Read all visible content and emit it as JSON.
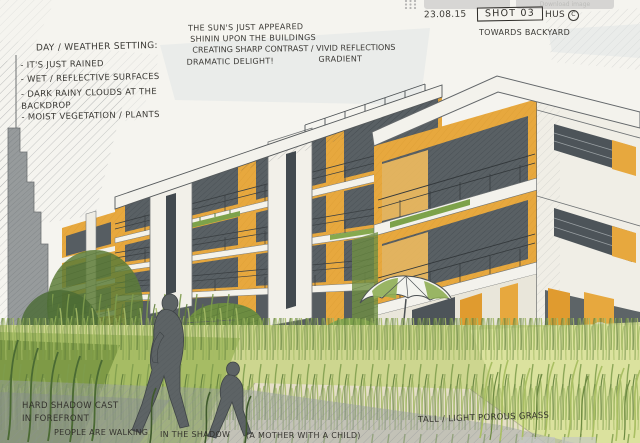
{
  "toolbar": {
    "grid_icon": "grid-dots-icon",
    "buttons": [
      {
        "label": ""
      },
      {
        "label": "Download image"
      }
    ]
  },
  "annotations": {
    "weather": {
      "title": "DAY / WEATHER SETTING:",
      "items": [
        "- IT'S JUST RAINED",
        "- WET / REFLECTIVE SURFACES",
        "- DARK RAINY CLOUDS AT THE BACKDROP",
        "- MOIST VEGETATION / PLANTS"
      ]
    },
    "sunlight": {
      "line1": "THE SUN'S JUST APPEARED",
      "line2": "SHININ UPON THE BUILDINGS",
      "line3": "CREATING SHARP CONTRAST / VIVID REFLECTIONS",
      "line4": "DRAMATIC DELIGHT!",
      "line5": "GRADIENT"
    },
    "shot_info": {
      "date": "23.08.15",
      "shot": "SHOT 03",
      "author": "HUS",
      "copyright_mark": "C",
      "direction": "TOWARDS BACKYARD"
    },
    "foreground": {
      "line1": "HARD SHADOW CAST",
      "line2": "IN FOREFRONT",
      "line3": "PEOPLE ARE WALKING",
      "line4": "IN THE SHADOW",
      "line5": "(A MOTHER WITH A CHILD)"
    },
    "grass": "TALL / LIGHT POROUS GRASS"
  },
  "palette": {
    "paper": "#f5f4ef",
    "ink": "#2e2c28",
    "facade_orange": "#e7a83e",
    "facade_orange_deep": "#d8941f",
    "window_dark": "#4d5459",
    "concrete_white": "#f2f1ea",
    "sky_blue_gray": "#d9e2e4",
    "cloud_gray": "#8e9294",
    "grass_light": "#cdd68f",
    "grass_mid": "#8fae54",
    "grass_dark": "#4a6a33",
    "shadow_gray": "#9aa0a2",
    "figure_gray": "#5d6365",
    "path_tan": "#e6dfc9"
  }
}
